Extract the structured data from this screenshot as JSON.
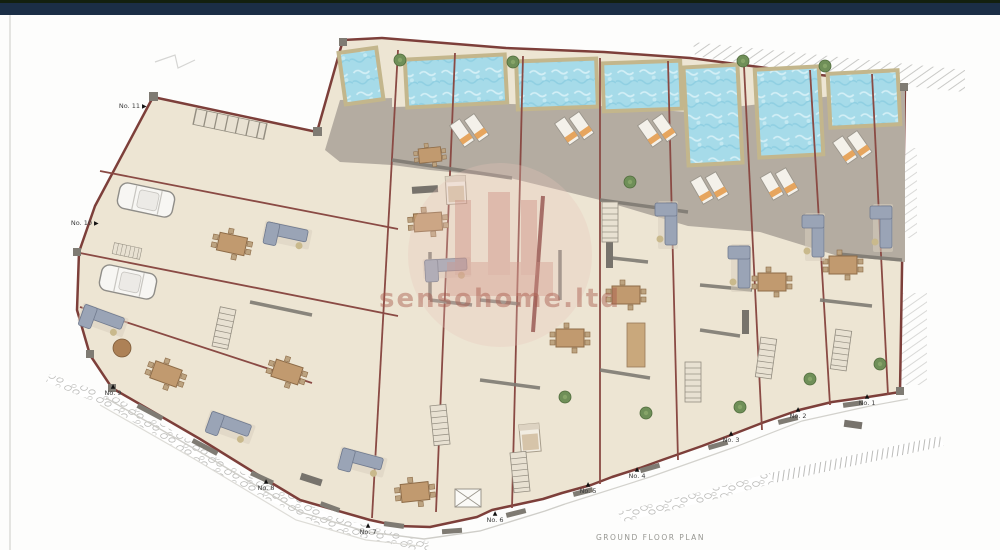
{
  "plan": {
    "title": "GROUND FLOOR PLAN",
    "watermark_text": "sensohome.ltd",
    "units": [
      {
        "label": "No. 1",
        "marker": "▲"
      },
      {
        "label": "No. 2",
        "marker": "▲"
      },
      {
        "label": "No. 3",
        "marker": "▲"
      },
      {
        "label": "No. 4",
        "marker": "▲"
      },
      {
        "label": "No. 5",
        "marker": "▲"
      },
      {
        "label": "No. 6",
        "marker": "▲"
      },
      {
        "label": "No. 7",
        "marker": "▲"
      },
      {
        "label": "No. 8",
        "marker": "▲"
      },
      {
        "label": "No. 9",
        "marker": "▲"
      },
      {
        "label": "No. 10",
        "marker": "▶"
      },
      {
        "label": "No. 11",
        "marker": "▶"
      }
    ],
    "pool_count": 7
  },
  "colors": {
    "top_bar": "#1b2e46",
    "wall_red": "#7d3f3a",
    "floor_beige": "#ede5d3",
    "terrace_gray": "#b4aca1",
    "pool_water": "#a6dbe9",
    "pool_border": "#c3b68c",
    "watermark_pink": "#dba89b"
  }
}
